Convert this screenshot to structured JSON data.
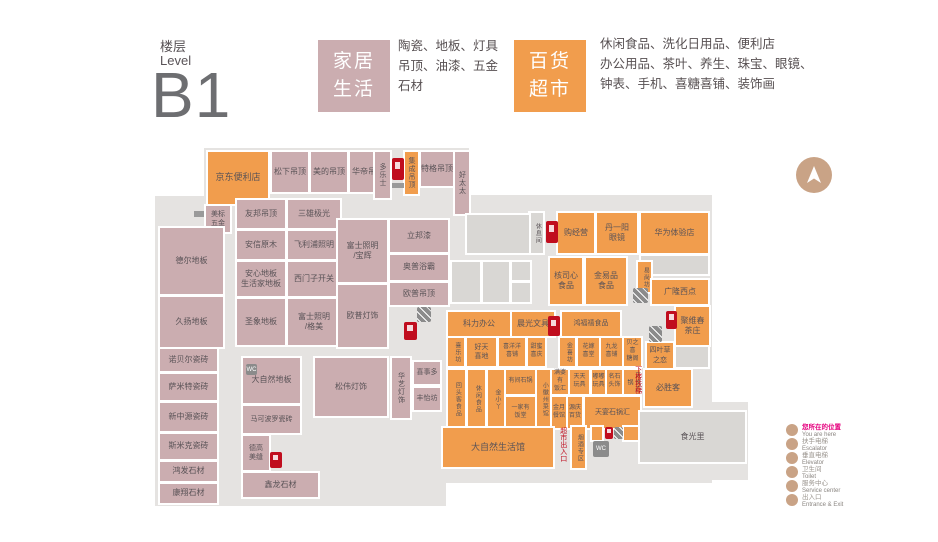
{
  "header": {
    "floor_label_cn": "楼层",
    "floor_label_en": "Level",
    "floor_code": "B1"
  },
  "categories": [
    {
      "name": "家居\n生活",
      "desc": "陶瓷、地板、灯具\n吊顶、油漆、五金\n石材",
      "color": "#cbadb0"
    },
    {
      "name": "百货\n超市",
      "desc": "休闲食品、洗化日用品、便利店\n办公用品、茶叶、养生、珠宝、眼镜、\n钟表、手机、喜糖喜铺、装饰画",
      "color": "#f19d4d"
    }
  ],
  "colors": {
    "home_living": "#cbadb0",
    "department_market": "#f19d4d",
    "unlabeled": "#d9d7d4",
    "floor": "#e5e3e1",
    "alert_red": "#c00d1e",
    "legend_tan": "#c9a386"
  },
  "map": {
    "plates": [
      {
        "x": 204,
        "y": 148,
        "w": 265,
        "h": 70
      },
      {
        "x": 155,
        "y": 196,
        "w": 291,
        "h": 310
      },
      {
        "x": 440,
        "y": 195,
        "w": 272,
        "h": 288
      },
      {
        "x": 612,
        "y": 402,
        "w": 136,
        "h": 78
      }
    ],
    "shops": [
      {
        "label": "京东便利店",
        "x": 208,
        "y": 152,
        "w": 60,
        "h": 52,
        "t": "m",
        "fs": 9
      },
      {
        "label": "松下吊顶",
        "x": 272,
        "y": 152,
        "w": 36,
        "h": 40,
        "t": "h"
      },
      {
        "label": "美的吊顶",
        "x": 311,
        "y": 152,
        "w": 36,
        "h": 40,
        "t": "h"
      },
      {
        "label": "华帝吊顶",
        "x": 350,
        "y": 152,
        "w": 36,
        "h": 40,
        "t": "h"
      },
      {
        "label": "多乐士",
        "x": 375,
        "y": 152,
        "w": 15,
        "h": 46,
        "t": "h",
        "v": true,
        "fs": 7
      },
      {
        "label": "集成吊顶",
        "x": 405,
        "y": 152,
        "w": 13,
        "h": 42,
        "t": "m",
        "v": true,
        "fs": 7
      },
      {
        "label": "特格吊顶",
        "x": 421,
        "y": 152,
        "w": 32,
        "h": 34,
        "t": "h"
      },
      {
        "label": "好太太",
        "x": 455,
        "y": 152,
        "w": 14,
        "h": 62,
        "t": "h",
        "v": true,
        "fs": 7
      },
      {
        "label": "美标\n五金",
        "x": 206,
        "y": 206,
        "w": 24,
        "h": 26,
        "t": "h",
        "fs": 7
      },
      {
        "label": "友邦吊顶",
        "x": 237,
        "y": 200,
        "w": 48,
        "h": 28,
        "t": "h"
      },
      {
        "label": "三雄极光",
        "x": 288,
        "y": 200,
        "w": 52,
        "h": 28,
        "t": "h"
      },
      {
        "label": "安信原木",
        "x": 237,
        "y": 231,
        "w": 48,
        "h": 28,
        "t": "h"
      },
      {
        "label": "飞利浦照明",
        "x": 288,
        "y": 231,
        "w": 52,
        "h": 28,
        "t": "h"
      },
      {
        "label": "安心地板\n生活家地板",
        "x": 237,
        "y": 262,
        "w": 48,
        "h": 34,
        "t": "h"
      },
      {
        "label": "西门子开关",
        "x": 288,
        "y": 262,
        "w": 52,
        "h": 34,
        "t": "h"
      },
      {
        "label": "圣象地板",
        "x": 237,
        "y": 299,
        "w": 48,
        "h": 46,
        "t": "h"
      },
      {
        "label": "富士照明\n/格美",
        "x": 288,
        "y": 299,
        "w": 52,
        "h": 46,
        "t": "h"
      },
      {
        "label": "德尔地板",
        "x": 160,
        "y": 228,
        "w": 63,
        "h": 66,
        "t": "h"
      },
      {
        "label": "久扬地板",
        "x": 160,
        "y": 297,
        "w": 63,
        "h": 50,
        "t": "h"
      },
      {
        "label": "诺贝尔瓷砖",
        "x": 160,
        "y": 349,
        "w": 57,
        "h": 22,
        "t": "h"
      },
      {
        "label": "萨米特瓷砖",
        "x": 160,
        "y": 374,
        "w": 57,
        "h": 26,
        "t": "h"
      },
      {
        "label": "新中源瓷砖",
        "x": 160,
        "y": 403,
        "w": 57,
        "h": 28,
        "t": "h"
      },
      {
        "label": "斯米克瓷砖",
        "x": 160,
        "y": 434,
        "w": 57,
        "h": 25,
        "t": "h"
      },
      {
        "label": "鸿发石材",
        "x": 160,
        "y": 462,
        "w": 57,
        "h": 19,
        "t": "h"
      },
      {
        "label": "康翔石材",
        "x": 160,
        "y": 484,
        "w": 57,
        "h": 19,
        "t": "h"
      },
      {
        "label": "大自然地板",
        "x": 243,
        "y": 358,
        "w": 57,
        "h": 45,
        "t": "h"
      },
      {
        "label": "马可波罗瓷砖",
        "x": 243,
        "y": 406,
        "w": 57,
        "h": 27,
        "t": "h",
        "fs": 7
      },
      {
        "label": "德高\n美缝",
        "x": 243,
        "y": 436,
        "w": 26,
        "h": 34,
        "t": "h",
        "fs": 7
      },
      {
        "label": "鑫龙石材",
        "x": 243,
        "y": 473,
        "w": 75,
        "h": 24,
        "t": "h"
      },
      {
        "label": "富士照明\n/宝辉",
        "x": 338,
        "y": 220,
        "w": 49,
        "h": 62,
        "t": "h"
      },
      {
        "label": "立邦漆",
        "x": 390,
        "y": 220,
        "w": 58,
        "h": 32,
        "t": "h"
      },
      {
        "label": "奥普浴霸",
        "x": 390,
        "y": 255,
        "w": 58,
        "h": 25,
        "t": "h"
      },
      {
        "label": "欧普吊顶",
        "x": 390,
        "y": 283,
        "w": 58,
        "h": 22,
        "t": "h"
      },
      {
        "label": "欧普灯饰",
        "x": 338,
        "y": 285,
        "w": 49,
        "h": 62,
        "t": "h"
      },
      {
        "label": "松伟灯饰",
        "x": 315,
        "y": 358,
        "w": 72,
        "h": 58,
        "t": "h"
      },
      {
        "label": "华艺灯饰",
        "x": 392,
        "y": 358,
        "w": 18,
        "h": 60,
        "t": "h",
        "v": true,
        "fs": 7
      },
      {
        "label": "喜事多",
        "x": 414,
        "y": 362,
        "w": 26,
        "h": 22,
        "t": "h",
        "fs": 7
      },
      {
        "label": "丰怡坊",
        "x": 414,
        "y": 388,
        "w": 26,
        "h": 22,
        "t": "h",
        "fs": 7
      },
      {
        "label": "休息间",
        "x": 530,
        "y": 213,
        "w": 13,
        "h": 40,
        "t": "g",
        "v": true,
        "fs": 6
      },
      {
        "label": "",
        "x": 467,
        "y": 215,
        "w": 62,
        "h": 38,
        "t": "g"
      },
      {
        "label": "",
        "x": 452,
        "y": 262,
        "w": 28,
        "h": 40,
        "t": "g"
      },
      {
        "label": "",
        "x": 483,
        "y": 262,
        "w": 26,
        "h": 40,
        "t": "g"
      },
      {
        "label": "",
        "x": 512,
        "y": 262,
        "w": 18,
        "h": 18,
        "t": "g"
      },
      {
        "label": "",
        "x": 512,
        "y": 283,
        "w": 18,
        "h": 19,
        "t": "g"
      },
      {
        "label": "购经营",
        "x": 558,
        "y": 213,
        "w": 36,
        "h": 40,
        "t": "m"
      },
      {
        "label": "丹一阳\n眼镜",
        "x": 597,
        "y": 213,
        "w": 40,
        "h": 40,
        "t": "m"
      },
      {
        "label": "华为体验店",
        "x": 641,
        "y": 213,
        "w": 67,
        "h": 40,
        "t": "m"
      },
      {
        "label": "",
        "x": 641,
        "y": 256,
        "w": 67,
        "h": 18,
        "t": "g"
      },
      {
        "label": "核司心\n食品",
        "x": 550,
        "y": 258,
        "w": 32,
        "h": 46,
        "t": "m"
      },
      {
        "label": "金易品\n食品",
        "x": 586,
        "y": 258,
        "w": 40,
        "h": 46,
        "t": "m"
      },
      {
        "label": "易尚坊",
        "x": 638,
        "y": 262,
        "w": 13,
        "h": 30,
        "t": "m",
        "v": true,
        "fs": 6
      },
      {
        "label": "广隆西点",
        "x": 652,
        "y": 280,
        "w": 56,
        "h": 24,
        "t": "m"
      },
      {
        "label": "聚维春\n茶庄",
        "x": 676,
        "y": 307,
        "w": 33,
        "h": 38,
        "t": "m"
      },
      {
        "label": "四叶草\n之恋",
        "x": 647,
        "y": 343,
        "w": 26,
        "h": 25,
        "t": "m",
        "fs": 7
      },
      {
        "label": "",
        "x": 676,
        "y": 347,
        "w": 32,
        "h": 20,
        "t": "g"
      },
      {
        "label": "必胜客",
        "x": 645,
        "y": 370,
        "w": 46,
        "h": 36,
        "t": "m"
      },
      {
        "label": "科力办公",
        "x": 448,
        "y": 312,
        "w": 62,
        "h": 24,
        "t": "m"
      },
      {
        "label": "晨光文具",
        "x": 512,
        "y": 312,
        "w": 42,
        "h": 24,
        "t": "m"
      },
      {
        "label": "鸿福禧食品",
        "x": 562,
        "y": 312,
        "w": 58,
        "h": 24,
        "t": "m",
        "fs": 7
      },
      {
        "label": "喜乐坊",
        "x": 448,
        "y": 338,
        "w": 16,
        "h": 28,
        "t": "m",
        "v": true,
        "fs": 6
      },
      {
        "label": "好天\n喜地",
        "x": 467,
        "y": 338,
        "w": 29,
        "h": 28,
        "t": "m",
        "fs": 7
      },
      {
        "label": "喜洋洋\n喜铺",
        "x": 499,
        "y": 338,
        "w": 26,
        "h": 28,
        "t": "m",
        "fs": 6
      },
      {
        "label": "甜蜜\n喜庆",
        "x": 528,
        "y": 338,
        "w": 17,
        "h": 28,
        "t": "m",
        "fs": 6
      },
      {
        "label": "金喜坊",
        "x": 560,
        "y": 338,
        "w": 15,
        "h": 28,
        "t": "m",
        "v": true,
        "fs": 6
      },
      {
        "label": "花嫁\n喜堂",
        "x": 578,
        "y": 338,
        "w": 21,
        "h": 28,
        "t": "m",
        "fs": 6
      },
      {
        "label": "九龙\n喜铺",
        "x": 601,
        "y": 338,
        "w": 21,
        "h": 28,
        "t": "m",
        "fs": 6
      },
      {
        "label": "贝之喜\n糖阁",
        "x": 624,
        "y": 338,
        "w": 17,
        "h": 28,
        "t": "m",
        "fs": 6
      },
      {
        "label": "回头客食品",
        "x": 448,
        "y": 370,
        "w": 17,
        "h": 58,
        "t": "m",
        "v": true,
        "fs": 6
      },
      {
        "label": "休闲食品",
        "x": 468,
        "y": 370,
        "w": 17,
        "h": 58,
        "t": "m",
        "v": true,
        "fs": 6
      },
      {
        "label": "金小丫",
        "x": 488,
        "y": 370,
        "w": 16,
        "h": 58,
        "t": "m",
        "v": true,
        "fs": 6
      },
      {
        "label": "有间石锅",
        "x": 506,
        "y": 370,
        "w": 29,
        "h": 24,
        "t": "m",
        "fs": 6
      },
      {
        "label": "一家有\n饭堂",
        "x": 506,
        "y": 397,
        "w": 29,
        "h": 31,
        "t": "m",
        "fs": 6
      },
      {
        "label": "小徽州菜馆",
        "x": 537,
        "y": 370,
        "w": 13,
        "h": 58,
        "t": "m",
        "v": true,
        "fs": 6
      },
      {
        "label": "满婆有\n饭汇",
        "x": 552,
        "y": 370,
        "w": 16,
        "h": 24,
        "t": "m",
        "fs": 6
      },
      {
        "label": "金月\n餐馆",
        "x": 552,
        "y": 397,
        "w": 14,
        "h": 31,
        "t": "m",
        "fs": 6
      },
      {
        "label": "源庆\n百货",
        "x": 568,
        "y": 397,
        "w": 14,
        "h": 31,
        "t": "m",
        "fs": 6
      },
      {
        "label": "天天\n玩具",
        "x": 570,
        "y": 370,
        "w": 19,
        "h": 24,
        "t": "m",
        "fs": 6
      },
      {
        "label": "嘟嘟\n玩具",
        "x": 592,
        "y": 370,
        "w": 13,
        "h": 24,
        "t": "m",
        "fs": 6
      },
      {
        "label": "名石\n头饰",
        "x": 607,
        "y": 370,
        "w": 15,
        "h": 24,
        "t": "m",
        "fs": 6
      },
      {
        "label": "天悦石锅",
        "x": 624,
        "y": 370,
        "w": 16,
        "h": 24,
        "t": "m",
        "v": true,
        "fs": 6
      },
      {
        "label": "天宴石锅汇",
        "x": 585,
        "y": 397,
        "w": 55,
        "h": 31,
        "t": "m",
        "fs": 7
      },
      {
        "label": "大自然生活馆",
        "x": 443,
        "y": 428,
        "w": 110,
        "h": 39,
        "t": "m",
        "fs": 9
      },
      {
        "label": "烟酒专区",
        "x": 572,
        "y": 427,
        "w": 13,
        "h": 41,
        "t": "m",
        "v": true,
        "fs": 6
      },
      {
        "label": "",
        "x": 592,
        "y": 427,
        "w": 10,
        "h": 13,
        "t": "m"
      },
      {
        "label": "",
        "x": 624,
        "y": 427,
        "w": 20,
        "h": 13,
        "t": "m"
      },
      {
        "label": "食光里",
        "x": 640,
        "y": 412,
        "w": 105,
        "h": 50,
        "t": "g"
      }
    ],
    "texts": [
      {
        "label": "超市出入口",
        "x": 559,
        "y": 427,
        "v": true
      },
      {
        "label": "下楼扶梯",
        "x": 634,
        "y": 366,
        "v": true
      }
    ],
    "icons": [
      {
        "name": "fire-extinguisher-icon",
        "k": "fire",
        "x": 392,
        "y": 158,
        "w": 12,
        "h": 22
      },
      {
        "name": "escalator-icon",
        "k": "graybar",
        "x": 392,
        "y": 183,
        "w": 12,
        "h": 5
      },
      {
        "name": "escalator-icon",
        "k": "graybar",
        "x": 194,
        "y": 211,
        "w": 10,
        "h": 6
      },
      {
        "name": "escalator-icon",
        "k": "esc",
        "x": 417,
        "y": 307,
        "w": 14,
        "h": 15
      },
      {
        "name": "fire-extinguisher-icon",
        "k": "fire",
        "x": 404,
        "y": 322,
        "w": 13,
        "h": 18
      },
      {
        "name": "wc-icon",
        "k": "wc",
        "x": 246,
        "y": 364,
        "w": 11,
        "h": 11
      },
      {
        "name": "fire-extinguisher-icon",
        "k": "fire",
        "x": 270,
        "y": 452,
        "w": 12,
        "h": 16
      },
      {
        "name": "fire-extinguisher-icon",
        "k": "fire",
        "x": 546,
        "y": 221,
        "w": 12,
        "h": 22
      },
      {
        "name": "fire-extinguisher-icon",
        "k": "fire",
        "x": 548,
        "y": 316,
        "w": 12,
        "h": 20
      },
      {
        "name": "escalator-icon",
        "k": "esc",
        "x": 633,
        "y": 288,
        "w": 15,
        "h": 15
      },
      {
        "name": "fire-extinguisher-icon",
        "k": "fire",
        "x": 666,
        "y": 311,
        "w": 11,
        "h": 18
      },
      {
        "name": "escalator-icon",
        "k": "esc",
        "x": 649,
        "y": 326,
        "w": 13,
        "h": 16
      },
      {
        "name": "fire-extinguisher-icon",
        "k": "fire",
        "x": 605,
        "y": 427,
        "w": 8,
        "h": 12
      },
      {
        "name": "escalator-icon",
        "k": "esc",
        "x": 614,
        "y": 427,
        "w": 9,
        "h": 12
      },
      {
        "name": "wc-icon",
        "k": "wc",
        "x": 593,
        "y": 441,
        "w": 16,
        "h": 16
      }
    ]
  },
  "legend": {
    "items": [
      {
        "cn": "您所在的位置",
        "en": "You are here"
      },
      {
        "cn": "扶手电梯",
        "en": "Escalator"
      },
      {
        "cn": "垂直电梯",
        "en": "Elevator"
      },
      {
        "cn": "卫生间",
        "en": "Toilet"
      },
      {
        "cn": "服务中心",
        "en": "Service center"
      },
      {
        "cn": "出入口",
        "en": "Entrance & Exit"
      }
    ]
  },
  "compass": {
    "name": "north-compass",
    "direction": "N"
  }
}
